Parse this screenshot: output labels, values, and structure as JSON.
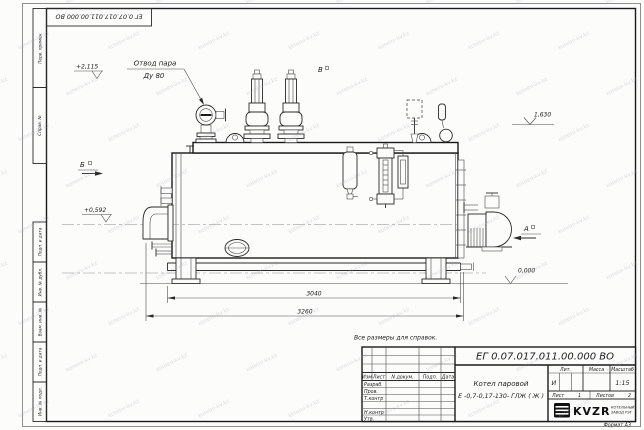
{
  "watermark": {
    "text": "kotelni-kv.kz"
  },
  "frame": {
    "corner_stamp": "ЕГ 0.07.017.011.00.000  ВО",
    "left_top_labels": [
      "Перв. примен.",
      "Справ. №"
    ],
    "left_bottom_labels": [
      "Подп. и дата",
      "Инв. № дубл.",
      "Взам. инв. №",
      "Подп. и дата",
      "Инв. № подл."
    ],
    "format_label": "Формат А3"
  },
  "drawing": {
    "callout_steam_line1": "Отвод пара",
    "callout_steam_line2": "Ду 80",
    "elevations": {
      "top_left": "+2,115",
      "left": "+0,592",
      "right_top": "1,630",
      "ground": "0,000"
    },
    "views": {
      "a": "А",
      "b": "Б",
      "v": "В"
    },
    "dimensions": {
      "inner": "3040",
      "outer": "3260"
    },
    "note": "Все размеры для справок."
  },
  "title_block": {
    "doc_number": "ЕГ 0.07.017.011.00.000  ВО",
    "product_name_line1": "Котел паровой",
    "product_name_line2": "Е -0,7-0,17-130- ГЛЖ ( Ж )",
    "columns": [
      "Изм",
      "Лист",
      "N докум.",
      "Подп.",
      "Дата"
    ],
    "rows": [
      "Разраб.",
      "Пров.",
      "Т.контр",
      "Н.контр",
      "Утв."
    ],
    "lit_label": "Лит.",
    "lit_value": "И",
    "mass_label": "Масса",
    "scale_label": "Масштаб",
    "scale_value": "1:15",
    "sheet_label": "Лист",
    "sheet_value": "1",
    "sheets_label": "Листов",
    "sheets_value": "2",
    "logo_text": "KVZR",
    "company_line1": "КОТЕЛЬНЫЙ",
    "company_line2": "ЗАВОД РЭТ"
  }
}
